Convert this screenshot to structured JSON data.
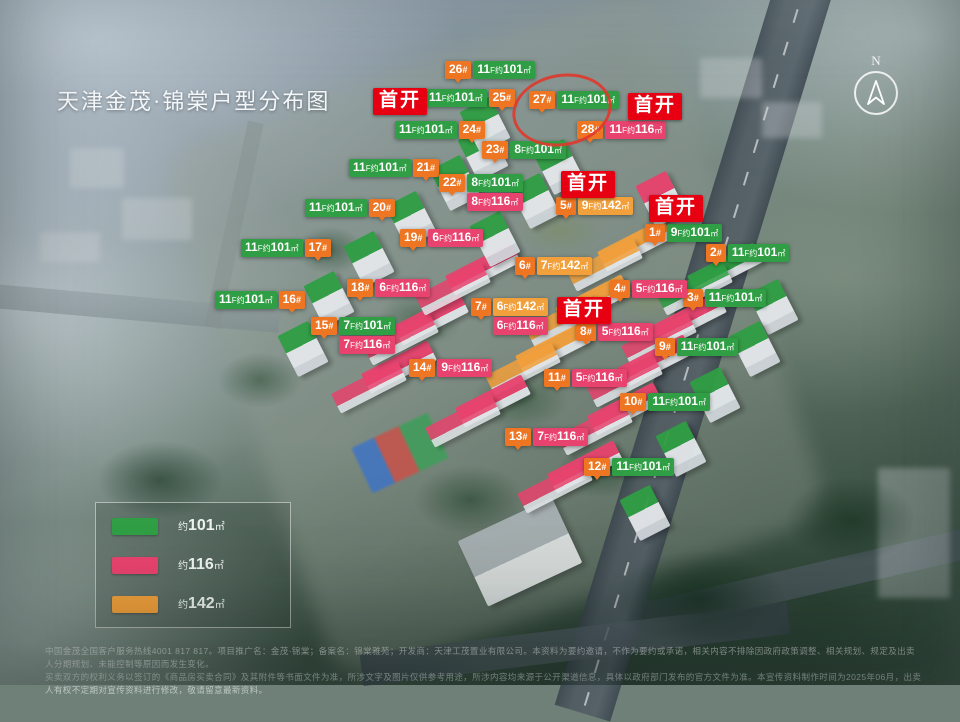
{
  "title": "天津金茂·锦棠户型分布图",
  "compass": {
    "north": "N"
  },
  "colors": {
    "green": "#2f9e44",
    "pink": "#e8436e",
    "orange": "#f2a03c",
    "badge": "#ee7623",
    "shoukai": "#e60012",
    "circle": "#e0392c"
  },
  "meta": {
    "num_suffix": "#",
    "fl_suffix": "F约",
    "area_unit": "㎡"
  },
  "shoukai": {
    "text": "首开",
    "positions": [
      {
        "x": 373,
        "y": 88
      },
      {
        "x": 628,
        "y": 93
      },
      {
        "x": 561,
        "y": 171
      },
      {
        "x": 649,
        "y": 195
      },
      {
        "x": 557,
        "y": 297
      }
    ]
  },
  "legend": {
    "items": [
      {
        "prefix": "约",
        "area": "101",
        "unit": "㎡",
        "color": "#2f9e44"
      },
      {
        "prefix": "约",
        "area": "116",
        "unit": "㎡",
        "color": "#e8436e"
      },
      {
        "prefix": "约",
        "area": "142",
        "unit": "㎡",
        "color": "#f2a03c"
      }
    ]
  },
  "buildings": [
    {
      "num": "1",
      "side": "left",
      "x": 645,
      "y": 224,
      "units": [
        {
          "fl": "9",
          "area": "101",
          "type": "green"
        }
      ],
      "block": {
        "x": 688,
        "y": 258,
        "kind": "slab",
        "type": "green"
      }
    },
    {
      "num": "2",
      "side": "left",
      "x": 706,
      "y": 244,
      "units": [
        {
          "fl": "11",
          "area": "101",
          "type": "green"
        }
      ],
      "block": {
        "x": 756,
        "y": 284,
        "kind": "tower",
        "type": "green"
      }
    },
    {
      "num": "3",
      "side": "left",
      "x": 683,
      "y": 289,
      "units": [
        {
          "fl": "11",
          "area": "101",
          "type": "green"
        }
      ],
      "block": {
        "x": 738,
        "y": 326,
        "kind": "tower",
        "type": "green"
      }
    },
    {
      "num": "4",
      "side": "left",
      "x": 610,
      "y": 280,
      "units": [
        {
          "fl": "5",
          "area": "116",
          "type": "pink"
        }
      ],
      "block": {
        "x": 652,
        "y": 308,
        "kind": "slab",
        "type": "pink"
      }
    },
    {
      "num": "5",
      "side": "left",
      "x": 556,
      "y": 197,
      "units": [
        {
          "fl": "9",
          "area": "142",
          "type": "orange"
        }
      ],
      "block": {
        "x": 598,
        "y": 234,
        "kind": "slab",
        "type": "orange"
      }
    },
    {
      "num": "6",
      "side": "left",
      "x": 515,
      "y": 257,
      "units": [
        {
          "fl": "7",
          "area": "142",
          "type": "orange"
        }
      ],
      "block": {
        "x": 556,
        "y": 290,
        "kind": "slab",
        "type": "orange"
      }
    },
    {
      "num": "7",
      "side": "left",
      "x": 471,
      "y": 298,
      "units": [
        {
          "fl": "6",
          "area": "142",
          "type": "orange"
        },
        {
          "fl": "6",
          "area": "116",
          "type": "pink"
        }
      ],
      "block": {
        "x": 516,
        "y": 338,
        "kind": "slab",
        "type": "orange"
      }
    },
    {
      "num": "8",
      "side": "left",
      "x": 576,
      "y": 323,
      "units": [
        {
          "fl": "5",
          "area": "116",
          "type": "pink"
        }
      ],
      "block": {
        "x": 618,
        "y": 350,
        "kind": "slab",
        "type": "pink"
      }
    },
    {
      "num": "9",
      "side": "left",
      "x": 655,
      "y": 338,
      "units": [
        {
          "fl": "11",
          "area": "101",
          "type": "green"
        }
      ],
      "block": {
        "x": 698,
        "y": 372,
        "kind": "tower",
        "type": "green"
      }
    },
    {
      "num": "10",
      "side": "left",
      "x": 620,
      "y": 393,
      "units": [
        {
          "fl": "11",
          "area": "101",
          "type": "green"
        }
      ],
      "block": {
        "x": 664,
        "y": 426,
        "kind": "tower",
        "type": "green"
      }
    },
    {
      "num": "11",
      "side": "left",
      "x": 544,
      "y": 369,
      "units": [
        {
          "fl": "5",
          "area": "116",
          "type": "pink"
        }
      ],
      "block": {
        "x": 588,
        "y": 398,
        "kind": "slab",
        "type": "pink"
      }
    },
    {
      "num": "12",
      "side": "left",
      "x": 584,
      "y": 458,
      "units": [
        {
          "fl": "11",
          "area": "101",
          "type": "green"
        }
      ],
      "block": {
        "x": 628,
        "y": 490,
        "kind": "tower",
        "type": "green"
      }
    },
    {
      "num": "13",
      "side": "left",
      "x": 505,
      "y": 428,
      "units": [
        {
          "fl": "7",
          "area": "116",
          "type": "pink"
        }
      ],
      "block": {
        "x": 548,
        "y": 456,
        "kind": "slab",
        "type": "pink"
      }
    },
    {
      "num": "14",
      "side": "left",
      "x": 409,
      "y": 359,
      "units": [
        {
          "fl": "9",
          "area": "116",
          "type": "pink"
        }
      ],
      "block": {
        "x": 456,
        "y": 390,
        "kind": "slab",
        "type": "pink"
      }
    },
    {
      "num": "15",
      "side": "left",
      "x": 311,
      "y": 317,
      "units": [
        {
          "fl": "7",
          "area": "101",
          "type": "green"
        },
        {
          "fl": "7",
          "area": "116",
          "type": "pink"
        }
      ],
      "block": {
        "x": 362,
        "y": 356,
        "kind": "slab",
        "type": "pink"
      }
    },
    {
      "num": "16",
      "side": "right",
      "x": 215,
      "y": 291,
      "units": [
        {
          "fl": "11",
          "area": "101",
          "type": "green"
        }
      ],
      "block": {
        "x": 286,
        "y": 326,
        "kind": "tower",
        "type": "green"
      }
    },
    {
      "num": "17",
      "side": "right",
      "x": 241,
      "y": 239,
      "units": [
        {
          "fl": "11",
          "area": "101",
          "type": "green"
        }
      ],
      "block": {
        "x": 312,
        "y": 276,
        "kind": "tower",
        "type": "green"
      }
    },
    {
      "num": "18",
      "side": "left",
      "x": 347,
      "y": 279,
      "units": [
        {
          "fl": "6",
          "area": "116",
          "type": "pink"
        }
      ],
      "block": {
        "x": 394,
        "y": 308,
        "kind": "slab",
        "type": "pink"
      }
    },
    {
      "num": "19",
      "side": "left",
      "x": 400,
      "y": 229,
      "units": [
        {
          "fl": "6",
          "area": "116",
          "type": "pink"
        }
      ],
      "block": {
        "x": 446,
        "y": 258,
        "kind": "slab",
        "type": "pink"
      }
    },
    {
      "num": "20",
      "side": "right",
      "x": 305,
      "y": 199,
      "units": [
        {
          "fl": "11",
          "area": "101",
          "type": "green"
        }
      ],
      "block": {
        "x": 352,
        "y": 236,
        "kind": "tower",
        "type": "green"
      }
    },
    {
      "num": "21",
      "side": "right",
      "x": 349,
      "y": 159,
      "units": [
        {
          "fl": "11",
          "area": "101",
          "type": "green"
        }
      ],
      "block": {
        "x": 394,
        "y": 196,
        "kind": "tower",
        "type": "green"
      }
    },
    {
      "num": "22",
      "side": "left",
      "x": 439,
      "y": 174,
      "units": [
        {
          "fl": "8",
          "area": "101",
          "type": "green"
        },
        {
          "fl": "8",
          "area": "116",
          "type": "pink"
        }
      ],
      "block": {
        "x": 478,
        "y": 216,
        "kind": "tower",
        "type": "green"
      }
    },
    {
      "num": "23",
      "side": "left",
      "x": 482,
      "y": 141,
      "units": [
        {
          "fl": "8",
          "area": "101",
          "type": "green"
        }
      ],
      "block": {
        "x": 518,
        "y": 178,
        "kind": "tower",
        "type": "green"
      }
    },
    {
      "num": "24",
      "side": "right",
      "x": 395,
      "y": 121,
      "units": [
        {
          "fl": "11",
          "area": "101",
          "type": "green"
        }
      ],
      "block": {
        "x": 438,
        "y": 160,
        "kind": "tower",
        "type": "green"
      }
    },
    {
      "num": "25",
      "side": "right",
      "x": 425,
      "y": 89,
      "units": [
        {
          "fl": "11",
          "area": "101",
          "type": "green"
        }
      ],
      "block": {
        "x": 466,
        "y": 130,
        "kind": "tower",
        "type": "green"
      }
    },
    {
      "num": "26",
      "side": "left",
      "x": 445,
      "y": 61,
      "units": [
        {
          "fl": "11",
          "area": "101",
          "type": "green"
        }
      ],
      "block": {
        "x": 468,
        "y": 102,
        "kind": "tower",
        "type": "green"
      }
    },
    {
      "num": "27",
      "side": "left",
      "x": 529,
      "y": 91,
      "units": [
        {
          "fl": "11",
          "area": "101",
          "type": "green"
        }
      ],
      "block": {
        "x": 542,
        "y": 144,
        "kind": "tower",
        "type": "green"
      }
    },
    {
      "num": "28",
      "side": "left",
      "x": 577,
      "y": 121,
      "units": [
        {
          "fl": "11",
          "area": "116",
          "type": "pink"
        }
      ],
      "block": {
        "x": 644,
        "y": 176,
        "kind": "tower",
        "type": "pink"
      }
    }
  ],
  "disclaimer": {
    "line1": "中国金茂全国客户服务热线4001 817 817。项目推广名：金茂·锦棠；备案名：锦棠雅苑；开发商：天津工茂置业有限公司。本资料为要约邀请，不作为要约或承诺，相关内容不排除因政府政策调整、相关规划、规定及出卖人分期规划、未能控制等原因而发生变化。",
    "line2": "买卖双方的权利义务以签订的《商品房买卖合同》及其附件等书面文件为准，所涉文字及图片仅供参考用途，所涉内容均来源于公开渠道信息，具体以政府部门发布的官方文件为准。本宣传资料制作时间为2025年06月，出卖人有权不定期对宣传资料进行修改，敬请留意最新资料。"
  }
}
